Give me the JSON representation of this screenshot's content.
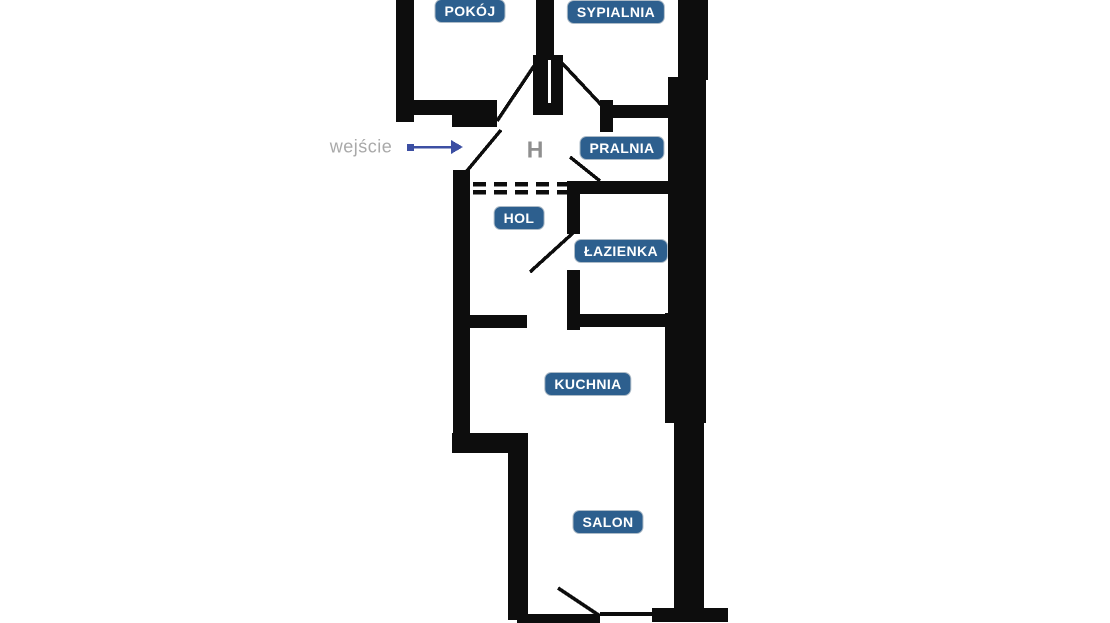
{
  "theme": {
    "background": "#ffffff",
    "wall": "#0d0d0d",
    "badge_bg": "#2d5f8e",
    "badge_text": "#ffffff",
    "arrow": "#3c4fa3",
    "entrance_text": "#a9a9a9",
    "hall_letter": "#8f8f8f"
  },
  "rooms": {
    "pokoj": {
      "label": "POKÓJ"
    },
    "sypialnia": {
      "label": "SYPIALNIA"
    },
    "pralnia": {
      "label": "PRALNIA"
    },
    "hol": {
      "label": "HOL"
    },
    "lazienka": {
      "label": "ŁAZIENKA"
    },
    "kuchnia": {
      "label": "KUCHNIA"
    },
    "salon": {
      "label": "SALON"
    }
  },
  "annotations": {
    "entrance": {
      "label": "wejście"
    },
    "hall_marker": {
      "label": "H"
    }
  }
}
